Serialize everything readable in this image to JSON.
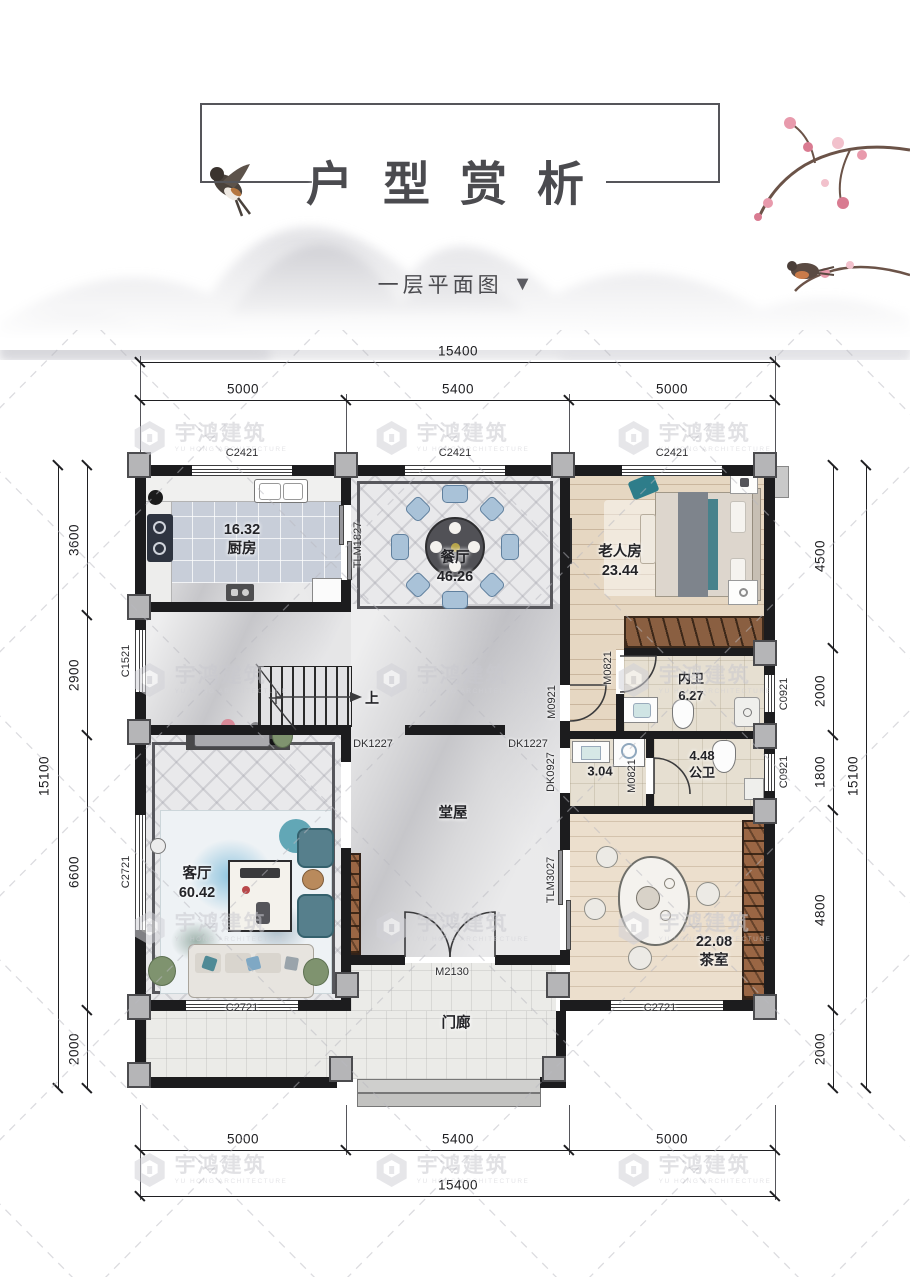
{
  "header": {
    "title": "户型赏析",
    "subtitle": "一层平面图",
    "subtitle_arrow": "▼"
  },
  "watermark": {
    "cn": "宇鸿建筑",
    "en": "YU HONG ARCHITECTURE"
  },
  "dimensions": {
    "top": {
      "total": "15400",
      "segments": [
        "5000",
        "5400",
        "5000"
      ]
    },
    "bottom": {
      "total": "15400",
      "segments": [
        "5000",
        "5400",
        "5000"
      ]
    },
    "left": {
      "total": "15100",
      "segments": [
        "3600",
        "2900",
        "6600",
        "2000"
      ]
    },
    "right": {
      "total": "15100",
      "segments": [
        "4500",
        "2000",
        "1800",
        "4800",
        "2000"
      ]
    }
  },
  "rooms": {
    "kitchen": {
      "area": "16.32",
      "name": "厨房"
    },
    "dining": {
      "name": "餐厅",
      "area": "46.26"
    },
    "elder_room": {
      "name": "老人房",
      "area": "23.44"
    },
    "inner_bath": {
      "name": "内卫",
      "area": "6.27"
    },
    "wash_area": {
      "area": "3.04"
    },
    "public_bath": {
      "area": "4.48",
      "name": "公卫"
    },
    "hall": {
      "name": "堂屋"
    },
    "living": {
      "name": "客厅",
      "area": "60.42"
    },
    "tea_room": {
      "area": "22.08",
      "name": "茶室"
    },
    "porch": {
      "name": "门廊"
    },
    "stair_up": "上"
  },
  "openings": {
    "window_top": "C2421",
    "kitchen_slide": "TLM1827",
    "stair_window": "C1521",
    "living_window": "C2721",
    "tea_window": "C2721",
    "bath_window": "C0921",
    "elder_door": "M0921",
    "bath_door": "M0821",
    "hall_opening": "DK1227",
    "wash_opening": "DK0927",
    "tea_slide": "TLM3027",
    "entry_door": "M2130"
  },
  "colors": {
    "wall": "#1c1c1e",
    "accent_teal": "#47828c",
    "chair_blue": "#a9c2d8",
    "wood_brown": "#9a6644",
    "watermark_gray": "#c9c9cf"
  }
}
